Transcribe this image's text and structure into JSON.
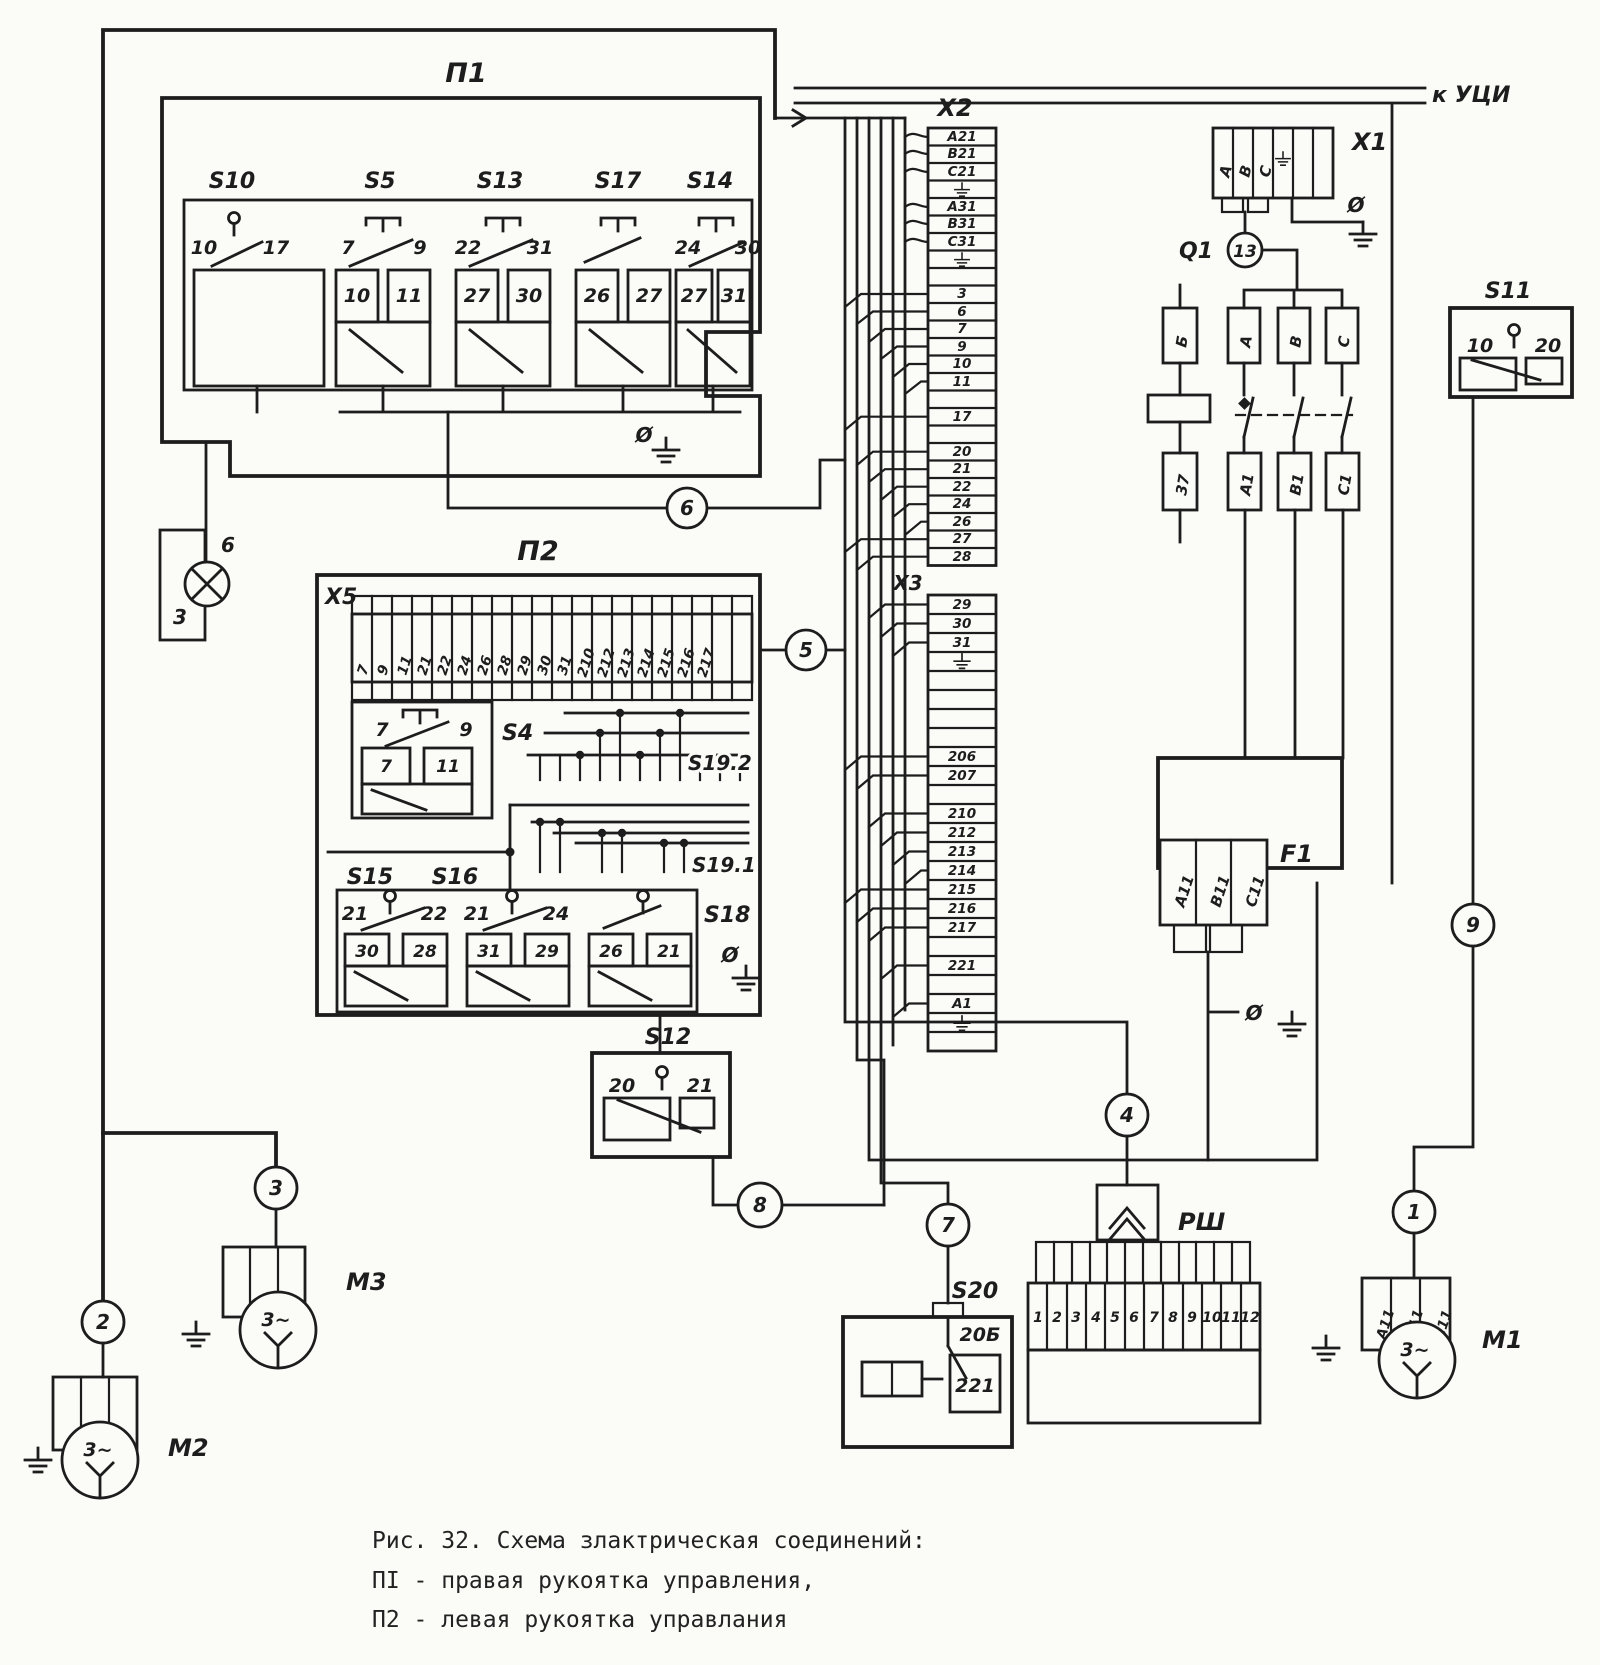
{
  "titles": {
    "p1": "П1",
    "p2": "П2",
    "x1": "X1",
    "x2": "X2",
    "x3": "X3",
    "x5": "X5",
    "q1": "Q1",
    "f1": "F1",
    "s4": "S4",
    "s10": "S10",
    "s5": "S5",
    "s13": "S13",
    "s17": "S17",
    "s14": "S14",
    "s11": "S11",
    "s12": "S12",
    "s15": "S15",
    "s16": "S16",
    "s18": "S18",
    "s19_1": "S19.1",
    "s19_2": "S19.2",
    "s20": "S20",
    "rsh": "РШ",
    "m1": "M1",
    "m2": "M2",
    "m3": "M3",
    "to_uci": "к УЦИ",
    "phase": "Ø",
    "motor": "3~"
  },
  "wires": {
    "w1": "1",
    "w2": "2",
    "w3": "3",
    "w4": "4",
    "w5": "5",
    "w6": "6",
    "w7": "7",
    "w8": "8",
    "w9": "9",
    "w13": "13"
  },
  "lamp": {
    "top": "6",
    "bottom": "3"
  },
  "sw": {
    "s10": {
      "a": "10",
      "b": "17"
    },
    "s5": {
      "a": "7",
      "b": "9",
      "c": "10",
      "d": "11"
    },
    "s13": {
      "a": "22",
      "b": "31",
      "c": "27",
      "d": "30"
    },
    "s17": {
      "c": "26",
      "d": "27"
    },
    "s14": {
      "a": "24",
      "b": "30",
      "c": "27",
      "d": "31"
    },
    "s4": {
      "a": "7",
      "b": "9",
      "c": "7",
      "d": "11"
    },
    "s15": {
      "a": "21",
      "b": "22",
      "c": "30",
      "d": "28"
    },
    "s16": {
      "a": "21",
      "b": "24",
      "c": "31",
      "d": "29"
    },
    "s18": {
      "c": "26",
      "d": "21"
    },
    "s11": {
      "a": "10",
      "b": "20"
    },
    "s12": {
      "a": "20",
      "b": "21"
    },
    "s20": {
      "contact": "20Б",
      "box": "221"
    }
  },
  "x2": [
    "A21",
    "B21",
    "C21",
    "",
    "A31",
    "B31",
    "C31",
    "",
    "",
    "3",
    "6",
    "7",
    "9",
    "10",
    "11",
    "",
    "17",
    "",
    "20",
    "21",
    "22",
    "24",
    "26",
    "27",
    "28"
  ],
  "x3": [
    "29",
    "30",
    "31",
    "",
    "",
    "",
    "",
    "",
    "206",
    "207",
    "",
    "210",
    "212",
    "213",
    "214",
    "215",
    "216",
    "217",
    "",
    "221",
    "",
    "A1",
    "",
    ""
  ],
  "x5": [
    "7",
    "9",
    "11",
    "21",
    "22",
    "24",
    "26",
    "28",
    "29",
    "30",
    "31",
    "210",
    "212",
    "213",
    "214",
    "215",
    "216",
    "217"
  ],
  "x1": [
    "A",
    "B",
    "C"
  ],
  "q1t": [
    "Б",
    "A",
    "B",
    "C"
  ],
  "q1b": [
    "37",
    "A1",
    "B1",
    "C1"
  ],
  "f1": [
    "A11",
    "B11",
    "C11"
  ],
  "m1t": [
    "A11",
    "B11",
    "C11"
  ],
  "rsh": [
    "1",
    "2",
    "3",
    "4",
    "5",
    "6",
    "7",
    "8",
    "9",
    "10",
    "11",
    "12"
  ],
  "caption": {
    "l1": "Рис. 32. Схема злактрическая соединений:",
    "l2": "ПI - правая рукоятка управления,",
    "l3": "П2 - левая рукоятка управлания"
  }
}
